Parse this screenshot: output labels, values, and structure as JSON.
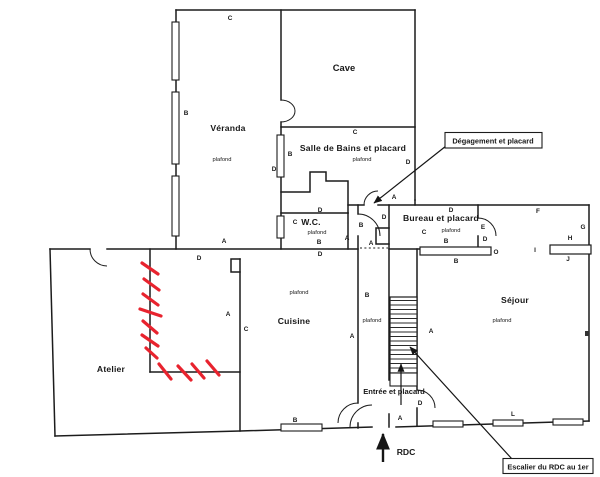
{
  "rooms": {
    "veranda": {
      "name": "Véranda",
      "ceiling": "plafond"
    },
    "cave": {
      "name": "Cave"
    },
    "salle_de_bains": {
      "name": "Salle de Bains et placard",
      "ceiling": "plafond"
    },
    "wc": {
      "name": "W.C.",
      "ceiling": "plafond"
    },
    "bureau": {
      "name": "Bureau et placard",
      "ceiling": "plafond"
    },
    "sejour": {
      "name": "Séjour",
      "ceiling": "plafond"
    },
    "cuisine": {
      "name": "Cuisine",
      "ceiling": "plafond"
    },
    "degagement": {
      "ceiling": "plafond"
    },
    "atelier": {
      "name": "Atelier"
    },
    "entree": {
      "name": "Entrée et placard"
    }
  },
  "callouts": {
    "degagement_placard": "Dégagement et placard",
    "escalier": "Escalier du RDC au 1er"
  },
  "floor_label": "RDC",
  "letters": [
    "C",
    "B",
    "B",
    "D",
    "C",
    "D",
    "A",
    "D",
    "B",
    "A",
    "A",
    "D",
    "C",
    "B",
    "D",
    "A",
    "D",
    "A",
    "C",
    "B",
    "B",
    "A",
    "A",
    "D",
    "A",
    "L",
    "D",
    "C",
    "E",
    "B",
    "D",
    "F",
    "G",
    "H",
    "I",
    "J",
    "O",
    "B"
  ],
  "colors": {
    "ink": "#1c1c1c",
    "highlight_red": "#e8232e",
    "paper": "#ffffff"
  }
}
